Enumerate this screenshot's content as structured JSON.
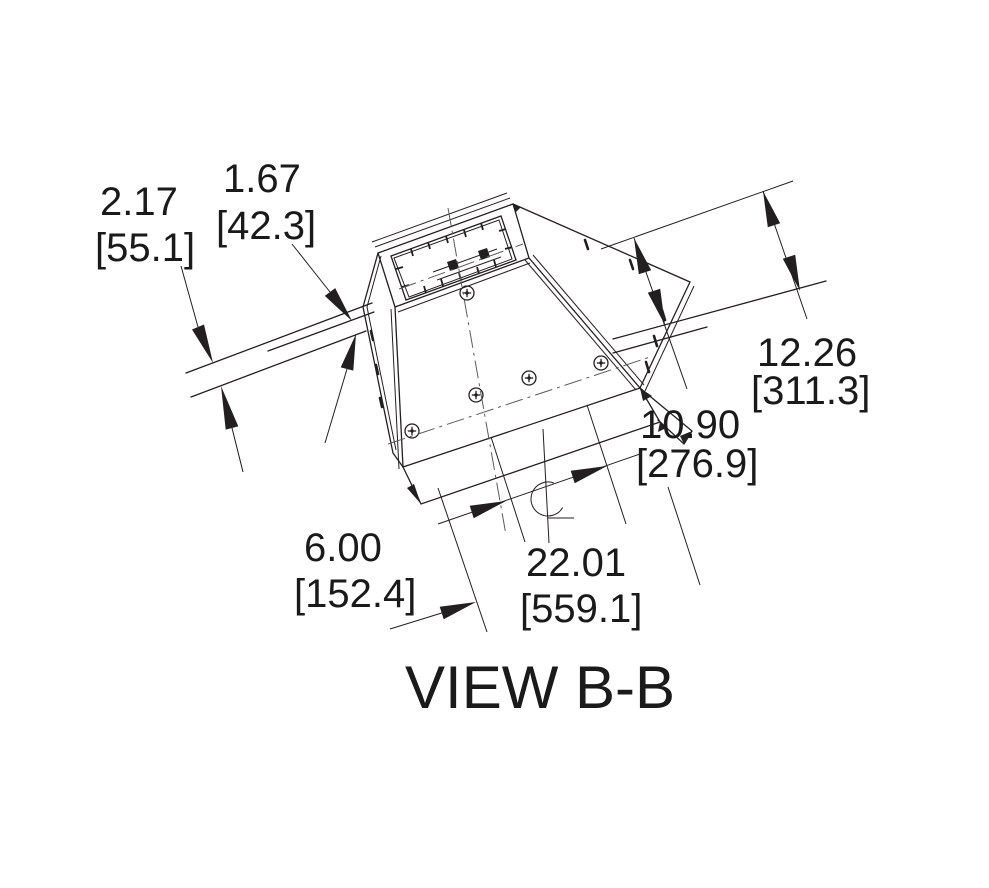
{
  "view_label": "VIEW B-B",
  "dims": {
    "deck_total": {
      "in": "2.17",
      "mm": "[55.1]"
    },
    "deck_panel": {
      "in": "1.67",
      "mm": "[42.3]"
    },
    "height_high": {
      "in": "12.26",
      "mm": "[311.3]"
    },
    "height_low": {
      "in": "10.90",
      "mm": "[276.9]"
    },
    "base_width": {
      "in": "22.01",
      "mm": "[559.1]"
    },
    "offset": {
      "in": "6.00",
      "mm": "[152.4]"
    }
  },
  "symbols": {
    "centerline": "centerline-of-curb"
  },
  "colors": {
    "line": "#231f20",
    "text": "#1a1a1a",
    "background": "#ffffff"
  }
}
